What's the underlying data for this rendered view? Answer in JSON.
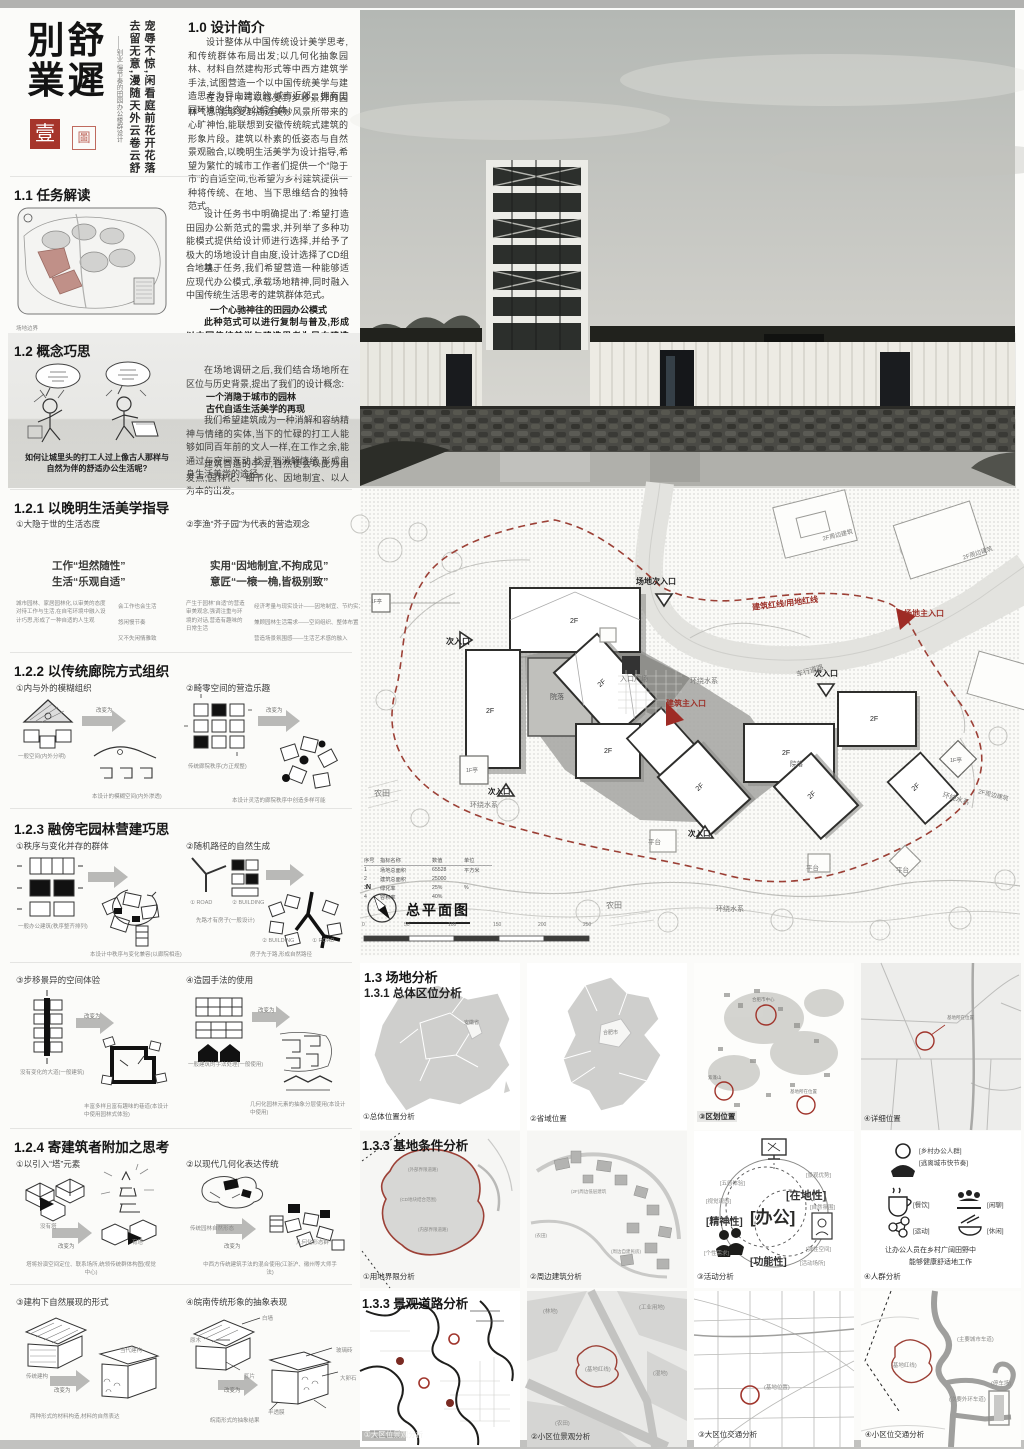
{
  "board": {
    "t1": "別",
    "t2": "業",
    "t3": "舒",
    "t4": "遲",
    "tagline1": "宠辱不惊,闲看庭前花开花落",
    "tagline2": "去留无意,漫随天外云卷云舒",
    "subtitle": "——别业·慢节奏的田园办公楼群设计",
    "seal1": "壹",
    "seal2": "圖"
  },
  "intro": {
    "title": "1.0 设计简介",
    "p1": "设计整体从中国传统设计美学思考,和传统群体布局出发;以几何化抽象园林、材料自然建构形式等中西方建筑学手法,试图营造一个以中国传统美学与建造思考为导向建造的,城市近郊、拥有田园环境的生态办公综合体。",
    "p2": "在设计中可以感受到步移景异的园林气息,能够受到周边美妙风景所带来的心旷神怡,能联想到安徽传统皖式建筑的形象片段。建筑以朴素的低姿态与自然景观融合,以晚明生活美学为设计指导,希望为繁忙的城市工作者们提供一个“隐于市”的自适空间,也希望为乡村建筑提供一种将传统、在地、当下思维结合的独特范式。"
  },
  "task": {
    "title": "1.1 任务解读",
    "p1": "设计任务书中明确提出了:希望打造田园办公新范式的需求,并列举了多种功能模式提供给设计师进行选择,并给予了极大的场地设计自由度,设计选择了CD组合地块。",
    "p2": "基于任务,我们希望营造一种能够适应现代办公模式,承载场地精神,同时融入中国传统生活思考的建筑群体范式。",
    "em": "一个心驰神往的田园办公模式",
    "p3": "此种范式可以进行复制与普及,形成以中国传统美学与建造思考为导向建造的,城市近郊、拥有田园环境的生态办公综合体。",
    "leg1": "场地边界",
    "leg2": "(保留的乡村建筑)",
    "cap": "“文脉传承,好山好水”——田园办公新范式"
  },
  "concept": {
    "title": "1.2 概念巧思",
    "cap": "如何让城里头的打工人过上像古人那样与自然为伴的舒适办公生活呢?",
    "p1": "在场地调研之后,我们结合场地所在区位与历史背景,提出了我们的设计概念:",
    "em1": "一个消隐于城市的园林",
    "em2": "古代自适生活美学的再现",
    "p2": "我们希望建筑成为一种消解和容纳精神与情绪的实体,当下的忙碌的打工人能够如同百年前的文人一样,在工作之余,能通过与空间互动,找寻到消解情绪,形成自身生活美学的途径。",
    "p3": "建筑营造的手法,自然便会以此为出发点,园林化、细节化、因地制宜、以人为本的出发。"
  },
  "s121": {
    "title": "1.2.1 以晚明生活美学指导",
    "a_label": "①大隐于世的生活态度",
    "a_q1": "工作“坦然随性”",
    "a_q2": "生活“乐观自适”",
    "a_note": "城市园林、家居园林化,以审美的态度对待工作与生活,在自宅环境中融入设计巧思,形成了一种自适的人生观",
    "a_l1": "会工作也会生活",
    "a_l2": "悠闲慢节奏",
    "a_l3": "又不失闲情雅致",
    "b_label": "②李渔“芥子园”为代表的营造观念",
    "b_q1": "实用“因地制宜,不拘成见”",
    "b_q2": "意匠“一榱一桷,皆极别致”",
    "b_note": "产生于园林“自适”的营造审美观念,强调注重与环境的对话,营造有趣味的日常生活",
    "b_l1": "经济考量与现实设计——因地制宜、节约实力",
    "b_l2": "兼顾园林生活需求——空间组织、整体布置",
    "b_l3": "营造场景氛围感——生活艺术感的融入"
  },
  "s122": {
    "title": "1.2.2 以传统廊院方式组织",
    "arrow": "改变为",
    "a_label": "①内与外的模糊组织",
    "a_c1": "一般空间(内外分明)",
    "a_c2": "本设计的模糊空间(内外渗透)",
    "b_label": "②畸零空间的营造乐趣",
    "b_c1": "传统廊院秩序(方正规整)",
    "b_c2": "本设计灵活的廊院秩序中创造多样可能"
  },
  "s123": {
    "title": "1.2.3 融傍宅园林营建巧思",
    "a_label": "①秩序与变化并存的群体",
    "a_c1": "一般办公建筑(秩序整齐排列)",
    "a_c2": "本设计中秩序与变化兼容(以廊院相连)",
    "b_label": "②随机路径的自然生成",
    "road": "① ROAD",
    "bldg": "② BUILDING",
    "b_c1": "先路才有房子(一般设计)",
    "b_c2": "房子先于路,形成自然路径"
  },
  "s12x": {
    "a_label": "③步移景异的空间体验",
    "a_c1": "没有变化的大道(一般建筑)",
    "a_c2": "丰富多样且富有趣味的巷道(本设计中使用园林式体验)",
    "b_label": "④造园手法的使用",
    "b_c1": "一般建筑的手法处理(一般使用)",
    "b_c2": "几何化园林元素的抽象分层使用(本设计中使用)"
  },
  "s124": {
    "title": "1.2.4 寄建筑者附加之思考",
    "arrow": "改变为",
    "a_label": "①以引入“塔”元素",
    "a_t1": "没有塔",
    "a_t2": "有塔",
    "a_cap": "塔将扮演空间定位、联系场所,统领传统群体构图(视觉中心)",
    "b_label": "②以现代几何化表达传统",
    "b_t1": "传统园林自然形态",
    "b_t2": "几何化形态群",
    "b_cap": "中西方传统建筑手法的混合使用(江浙沪、徽州等大师手法)"
  },
  "s12y": {
    "a_label": "③建构下自然展现的形式",
    "a_t1": "传统建构",
    "a_t2": "当代建构",
    "a_cap": "两种形式的材料构造,材料的自然表达",
    "b_label": "④皖南传统形象的抽象表现",
    "c1": "白墙",
    "c2": "原木",
    "c3": "瓦片",
    "c4": "玻璃砖",
    "c5": "大卵石",
    "c6": "半透膜",
    "b_cap": "皖南形式的抽象结果"
  },
  "plan": {
    "title": "总平面图",
    "north": "N",
    "lab": {
      "site_sub": "场地次入口",
      "site_main": "场地主入口",
      "redline": "建筑红线/用地红线",
      "main": "建筑主入口",
      "sub": "次入口",
      "water": "环绕水系",
      "road": "车行道路",
      "plaza": "入口广场",
      "yard": "院落",
      "farm": "农田",
      "deck": "平台",
      "pav": "1F亭",
      "f2": "2F",
      "nb": "2F周边建筑"
    },
    "tbl": {
      "h1": "序号",
      "h2": "指标名称",
      "h3": "数值",
      "h4": "单位",
      "r1": [
        "1",
        "场地总面积",
        "65528",
        "平方米"
      ],
      "r2": [
        "2",
        "建筑总面积",
        "25000",
        ""
      ],
      "r3": [
        "3",
        "绿化率",
        "25%",
        "%"
      ],
      "r4": [
        "4",
        "容积率",
        "40%",
        ""
      ]
    },
    "ticks": [
      "0",
      "50",
      "100",
      "150",
      "200",
      "250"
    ]
  },
  "a1": {
    "h1": "1.3 场地分析",
    "h2": "1.3.1 总体区位分析",
    "c1": "①总体位置分析",
    "l1": "安徽省",
    "c2": "②省域位置",
    "l2": "合肥市",
    "c3": "③区划位置",
    "l3a": "合肥市中心",
    "l3b": "紫蓬山",
    "l3c": "基地所在位置",
    "c4": "④详细位置",
    "l4": "基地所在位置"
  },
  "a2": {
    "h": "1.3.3 基地条件分析",
    "c1": "①用地界限分析",
    "l1a": "(外部界限道路)",
    "l1b": "(CD地块结合范围)",
    "l1c": "(内部界限道路)",
    "c2": "②周边建筑分析",
    "l2a": "(2F)周边低层建筑",
    "l2b": "(周边自建民房)",
    "c3": "③活动分析",
    "v0": "[办公]",
    "v1": "[在地性]",
    "v2": "[精神性]",
    "v3": "[功能性]",
    "s1": "[五感体验]",
    "s2": "[视觉观感]",
    "s3": "[景观优势]",
    "s4": "[自然氛围]",
    "s5": "[个性需求]",
    "s6": "[弹性空间]",
    "s7": "[活动场所]",
    "c4": "④人群分析",
    "g1": "[乡村办公人群]",
    "g2": "[逃离城市快节奏]",
    "i1": "[餐饮]",
    "i2": "[闲聊]",
    "i3": "[运动]",
    "i4": "[休闲]",
    "t1": "让办公人员在乡村广阔田野中",
    "t2": "能够健康舒适地工作"
  },
  "a3": {
    "h": "1.3.3 景观道路分析",
    "c1": "①大区位景观分析",
    "c2": "②小区位景观分析",
    "l2a": "(林地)",
    "l2b": "(工业用地)",
    "l2c": "(湿地)",
    "l2d": "(基地红线)",
    "l2e": "(农田)",
    "c3": "③大区位交通分析",
    "l3": "(基地位置)",
    "c4": "④小区位交通分析",
    "l4a": "(主要城市车道)",
    "l4b": "(基地红线)",
    "l4c": "(次要外环车道)",
    "l4d": "(停车场)"
  }
}
